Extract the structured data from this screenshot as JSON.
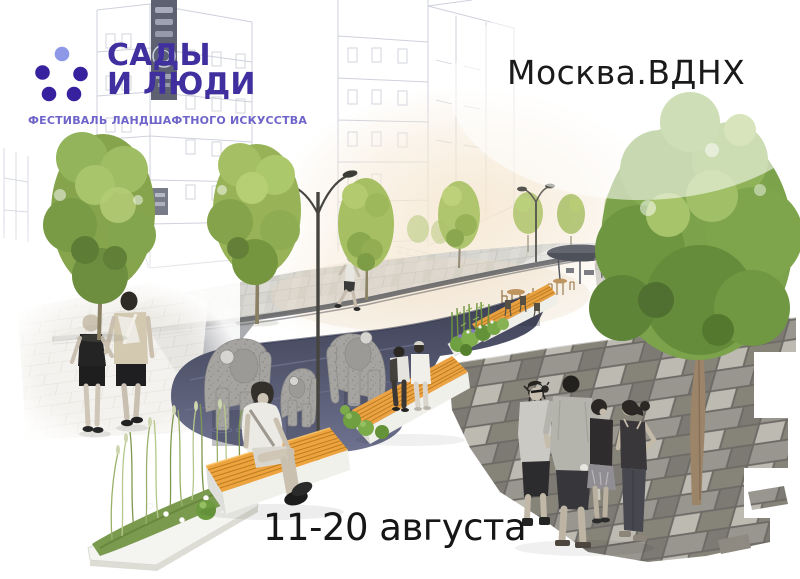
{
  "poster": {
    "background_color": "#ffffff",
    "logo": {
      "title_line1": "САДЫ",
      "title_line2": "И ЛЮДИ",
      "title_full": "САДЫ\nИ ЛЮДИ",
      "subtitle": "ФЕСТИВАЛЬ ЛАНДШАФТНОГО ИСКУССТВА",
      "colors": {
        "dots_dark": "#37219f",
        "dot_light": "#8d99e6",
        "title": "#40309f",
        "subtitle": "#6f64c9"
      }
    },
    "location": "Москва.ВДНХ",
    "dates": "11-20 августа",
    "text_color": "#161616",
    "illustration": {
      "elements": [
        "sketched-buildings",
        "chinese-sign",
        "street-trees",
        "street-lamps",
        "water-pool",
        "elephant-sculptures",
        "wooden-benches",
        "planter-with-grasses",
        "bamboo-planter",
        "cafe-tables-and-chairs",
        "canopy-pavilion",
        "paved-plaza",
        "stone-tile-pavement",
        "walking-couple",
        "jogger",
        "man-sitting-on-bench",
        "couple-on-bench",
        "group-of-people",
        "dog"
      ],
      "colors": {
        "foliage": "#85a44c",
        "bench_wood": "#eda43e",
        "water": "#4d5169",
        "paving_light": "#d7d6d1",
        "paving_dark": "#8a8781",
        "sketch_lines": "#c9cdd8"
      }
    }
  }
}
